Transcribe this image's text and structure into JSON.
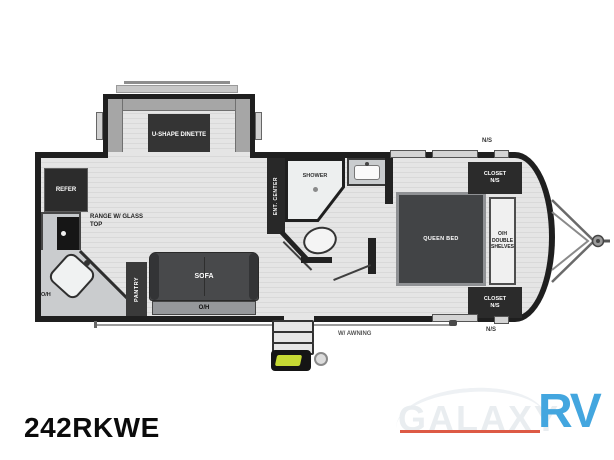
{
  "model": "242RKWE",
  "watermark": {
    "name": "GALAXY",
    "suffix": "RV"
  },
  "colors": {
    "wall": "#222222",
    "floor": "#dddddd",
    "logo_blue": "#43a6df",
    "logo_red": "#dd5a45",
    "badge_yellow": "#c6d934"
  },
  "labels": {
    "dinette": "U-SHAPE DINETTE",
    "refer": "REFER",
    "range": "RANGE W/ GLASS TOP",
    "kitchen_oh": "O/H",
    "pantry": "PANTRY",
    "sofa": "SOFA",
    "sofa_oh": "O/H",
    "ent_center": "ENT. CENTER",
    "shower": "SHOWER",
    "queen_bed": "QUEEN BED",
    "closet_top": "CLOSET\nN/S",
    "closet_bottom": "CLOSET\nN/S",
    "shelves": "O/H DOUBLE SHELVES",
    "marker_top": "N/S",
    "marker_bottom": "N/S",
    "awning": "W/ AWNING"
  }
}
